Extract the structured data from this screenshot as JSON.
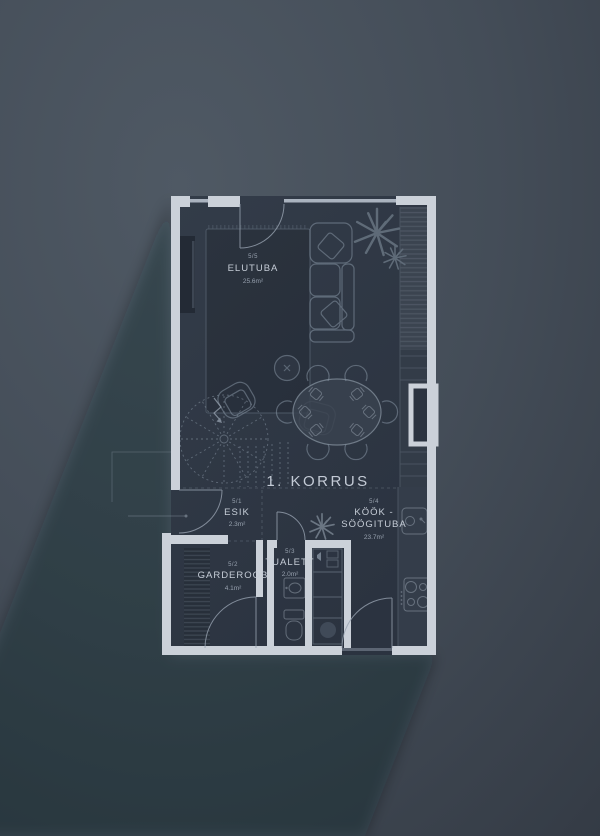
{
  "title": "1. KORRUS",
  "rooms": {
    "esik": {
      "unit": "5/1",
      "name": "ESIK",
      "area": "2.3m²"
    },
    "garderoob": {
      "unit": "5/2",
      "name": "GARDEROOB",
      "area": "4.1m²"
    },
    "tualett": {
      "unit": "5/3",
      "name": "TUALETT",
      "area": "2.0m²"
    },
    "kook": {
      "unit": "5/4",
      "name": "KÖÖK - SÖÖGITUBA",
      "name_line1": "KÖÖK -",
      "name_line2": "SÖÖGITUBA",
      "area": "23.7m²"
    },
    "elutuba": {
      "unit": "5/5",
      "name": "ELUTUBA",
      "area": "25.6m²"
    }
  },
  "colors": {
    "background": "#434c57",
    "floor": "#2f3743",
    "wall": "#cbd1d9",
    "room_name_text": "#c6cdd7",
    "muted_text": "#97a1ae",
    "furniture_line": "#8593a2"
  }
}
